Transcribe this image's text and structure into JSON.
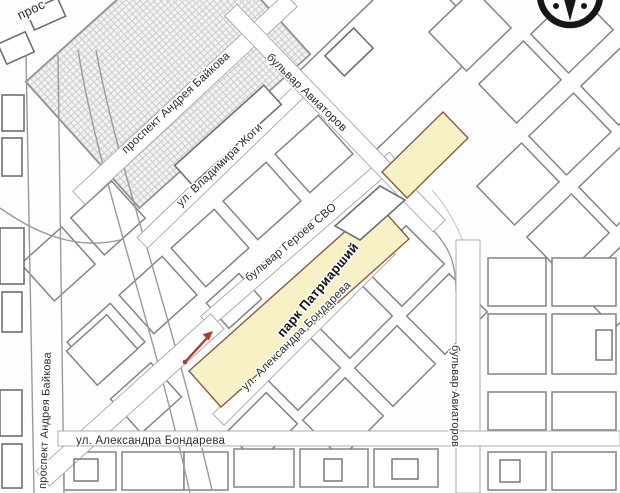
{
  "map": {
    "labels": {
      "prospekt_partial": "прос",
      "prospekt_baykova": "проспект Андрея Байкова",
      "vladimira_zhogi": "ул. Владимира Жоги",
      "aviatorov": "бульвар Авиаторов",
      "geroev_svo": "бульвар Героев СВО",
      "park": "парк Патриарший",
      "bondareva": "ул. Александра Бондарева"
    },
    "icons": {
      "compass": "compass-rose-north",
      "arrow": "route-direction-arrow"
    },
    "colors": {
      "park_fill": "#f8f1c6",
      "park_border": "#8d5a3e",
      "arrow_red": "#b03a2e",
      "line_gray": "#838383"
    }
  }
}
